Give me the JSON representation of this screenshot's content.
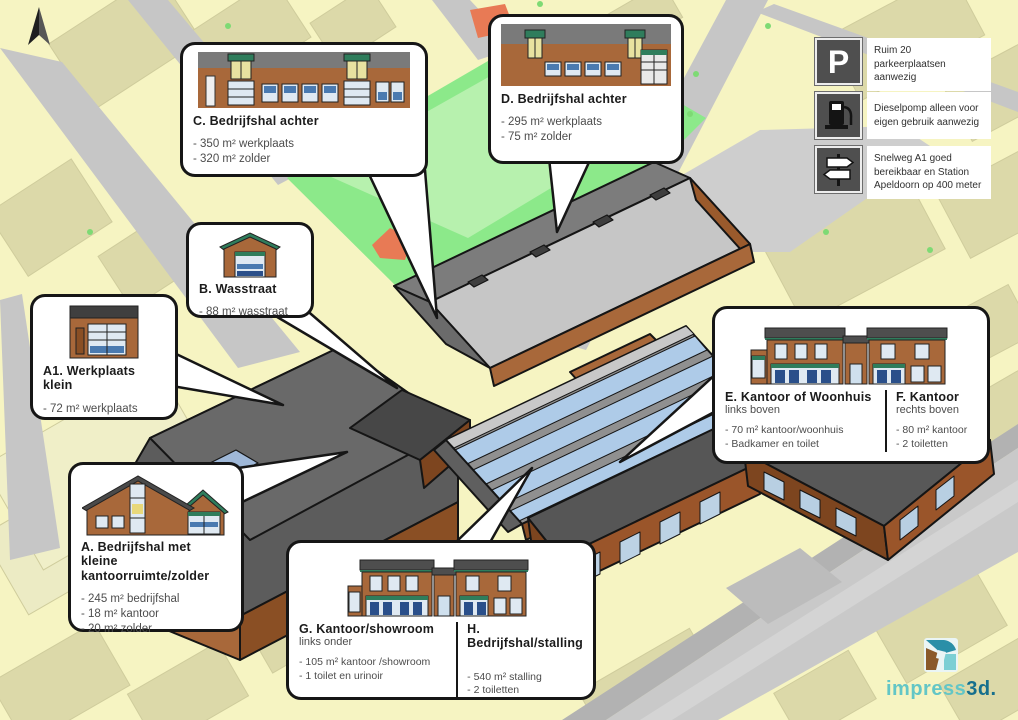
{
  "map": {
    "compass_icon": "north-arrow",
    "colors": {
      "background": "#f6f4c2",
      "block": "#dcd9a9",
      "road": "#c6c6c6",
      "grass": "#8ce98a",
      "grass_light": "#b7f1ae",
      "brick": "#a8683a",
      "brick_shade": "#7d451f",
      "roof_dark": "#5d5d5d",
      "roof_light": "#c6c6c6",
      "skylight_blue": "#aecbe8",
      "trim_green": "#2f7d5c"
    }
  },
  "info_boxes": [
    {
      "icon": "parking-icon",
      "symbol": "P",
      "text": "Ruim 20 parkeerplaatsen aanwezig"
    },
    {
      "icon": "fuel-pump-icon",
      "text": "Dieselpomp alleen voor eigen gebruik aanwezig"
    },
    {
      "icon": "signpost-icon",
      "text": "Snelweg A1 goed bereikbaar en Station Apeldoorn op 400 meter"
    }
  ],
  "callouts": {
    "c": {
      "title": "C. Bedrijfshal achter",
      "lines": [
        "- 350 m² werkplaats",
        "- 320 m² zolder"
      ],
      "image": "building-c"
    },
    "d": {
      "title": "D. Bedrijfshal achter",
      "lines": [
        "- 295 m² werkplaats",
        "- 75 m² zolder"
      ],
      "image": "building-d"
    },
    "b": {
      "title": "B. Wasstraat",
      "lines": [
        "- 88 m² wasstraat"
      ],
      "image": "building-b"
    },
    "a1": {
      "title": "A1. Werkplaats klein",
      "lines": [
        "- 72 m² werkplaats"
      ],
      "image": "building-a1"
    },
    "a": {
      "title": "A. Bedrijfshal met kleine kantoorruimte/zolder",
      "lines": [
        "- 245 m² bedrijfshal",
        "- 18 m² kantoor",
        "- 20 m² zolder"
      ],
      "image": "building-a"
    },
    "ef": {
      "image": "building-ef",
      "left": {
        "title": "E. Kantoor of Woonhuis",
        "subtitle": "links boven",
        "lines": [
          "- 70 m² kantoor/woonhuis",
          "- Badkamer en toilet"
        ]
      },
      "right": {
        "title": "F. Kantoor",
        "subtitle": "rechts boven",
        "lines": [
          "- 80 m² kantoor",
          "- 2 toiletten"
        ]
      }
    },
    "gh": {
      "image": "building-gh",
      "left": {
        "title": "G. Kantoor/showroom",
        "subtitle": "links onder",
        "lines": [
          "- 105 m² kantoor /showroom",
          "- 1 toilet en urinoir"
        ]
      },
      "right": {
        "title": "H. Bedrijfshal/stalling",
        "subtitle": "",
        "lines": [
          "- 540 m² stalling",
          "- 2 toiletten"
        ]
      }
    }
  },
  "logo": {
    "icon": "impress3d-logo",
    "part1": "impress",
    "part2": "3d."
  }
}
